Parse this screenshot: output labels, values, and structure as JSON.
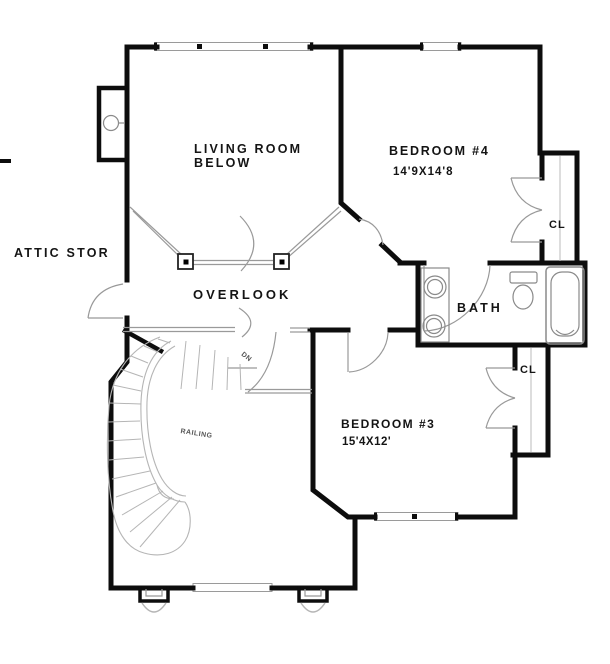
{
  "plan": {
    "title": "second-floor-plan",
    "labels": {
      "attic": "ATTIC STOR",
      "living_room_line1": "LIVING  ROOM",
      "living_room_line2": "BELOW",
      "overlook": "OVERLOOK",
      "bedroom4_name": "BEDROOM  #4",
      "bedroom4_dims": "14'9X14'8",
      "bedroom3_name": "BEDROOM #3",
      "bedroom3_dims": "15'4X12'",
      "bath": "BATH",
      "closet_bedroom4": "CL",
      "closet_bedroom3": "CL",
      "railing": "RAILING",
      "down": "DN"
    },
    "colors": {
      "background": "#ffffff",
      "wall": "#0d0d0d",
      "gray_line": "#999999",
      "light_gray": "#b5b5b5",
      "fixture_gray": "#8a8a8a",
      "text": "#141414"
    }
  }
}
